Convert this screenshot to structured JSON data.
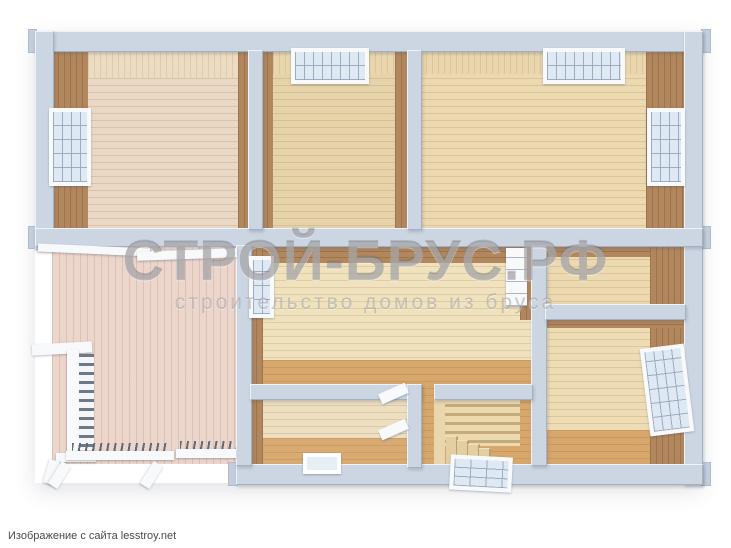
{
  "watermark": {
    "title": "СТРОЙ-БРУС.РФ",
    "subtitle": "строительство домов из бруса"
  },
  "attribution": {
    "text": "Изображение с сайта lesstroy.net"
  },
  "colors": {
    "wall": "#ccd6e3",
    "wall_edge": "#a4b1c2",
    "wood_dark": "#b2875e",
    "wood_light": "#e9d6ae",
    "floor_beige": "#e9d8b6",
    "floor_orange": "#d8a76c",
    "terrace_pink": "#ecd5cb",
    "fixture_white": "#f7f9fb",
    "watermark_gray": "#7d7d80"
  },
  "scene": {
    "type": "3d-floor-plan-render",
    "features": [
      "room-top-left",
      "room-top-middle",
      "room-top-right",
      "room-middle",
      "room-small-middle",
      "room-right-small",
      "room-bottom-right",
      "terrace",
      "staircase",
      "entrance-door",
      "floor-hatch",
      "railings",
      "windows"
    ]
  }
}
